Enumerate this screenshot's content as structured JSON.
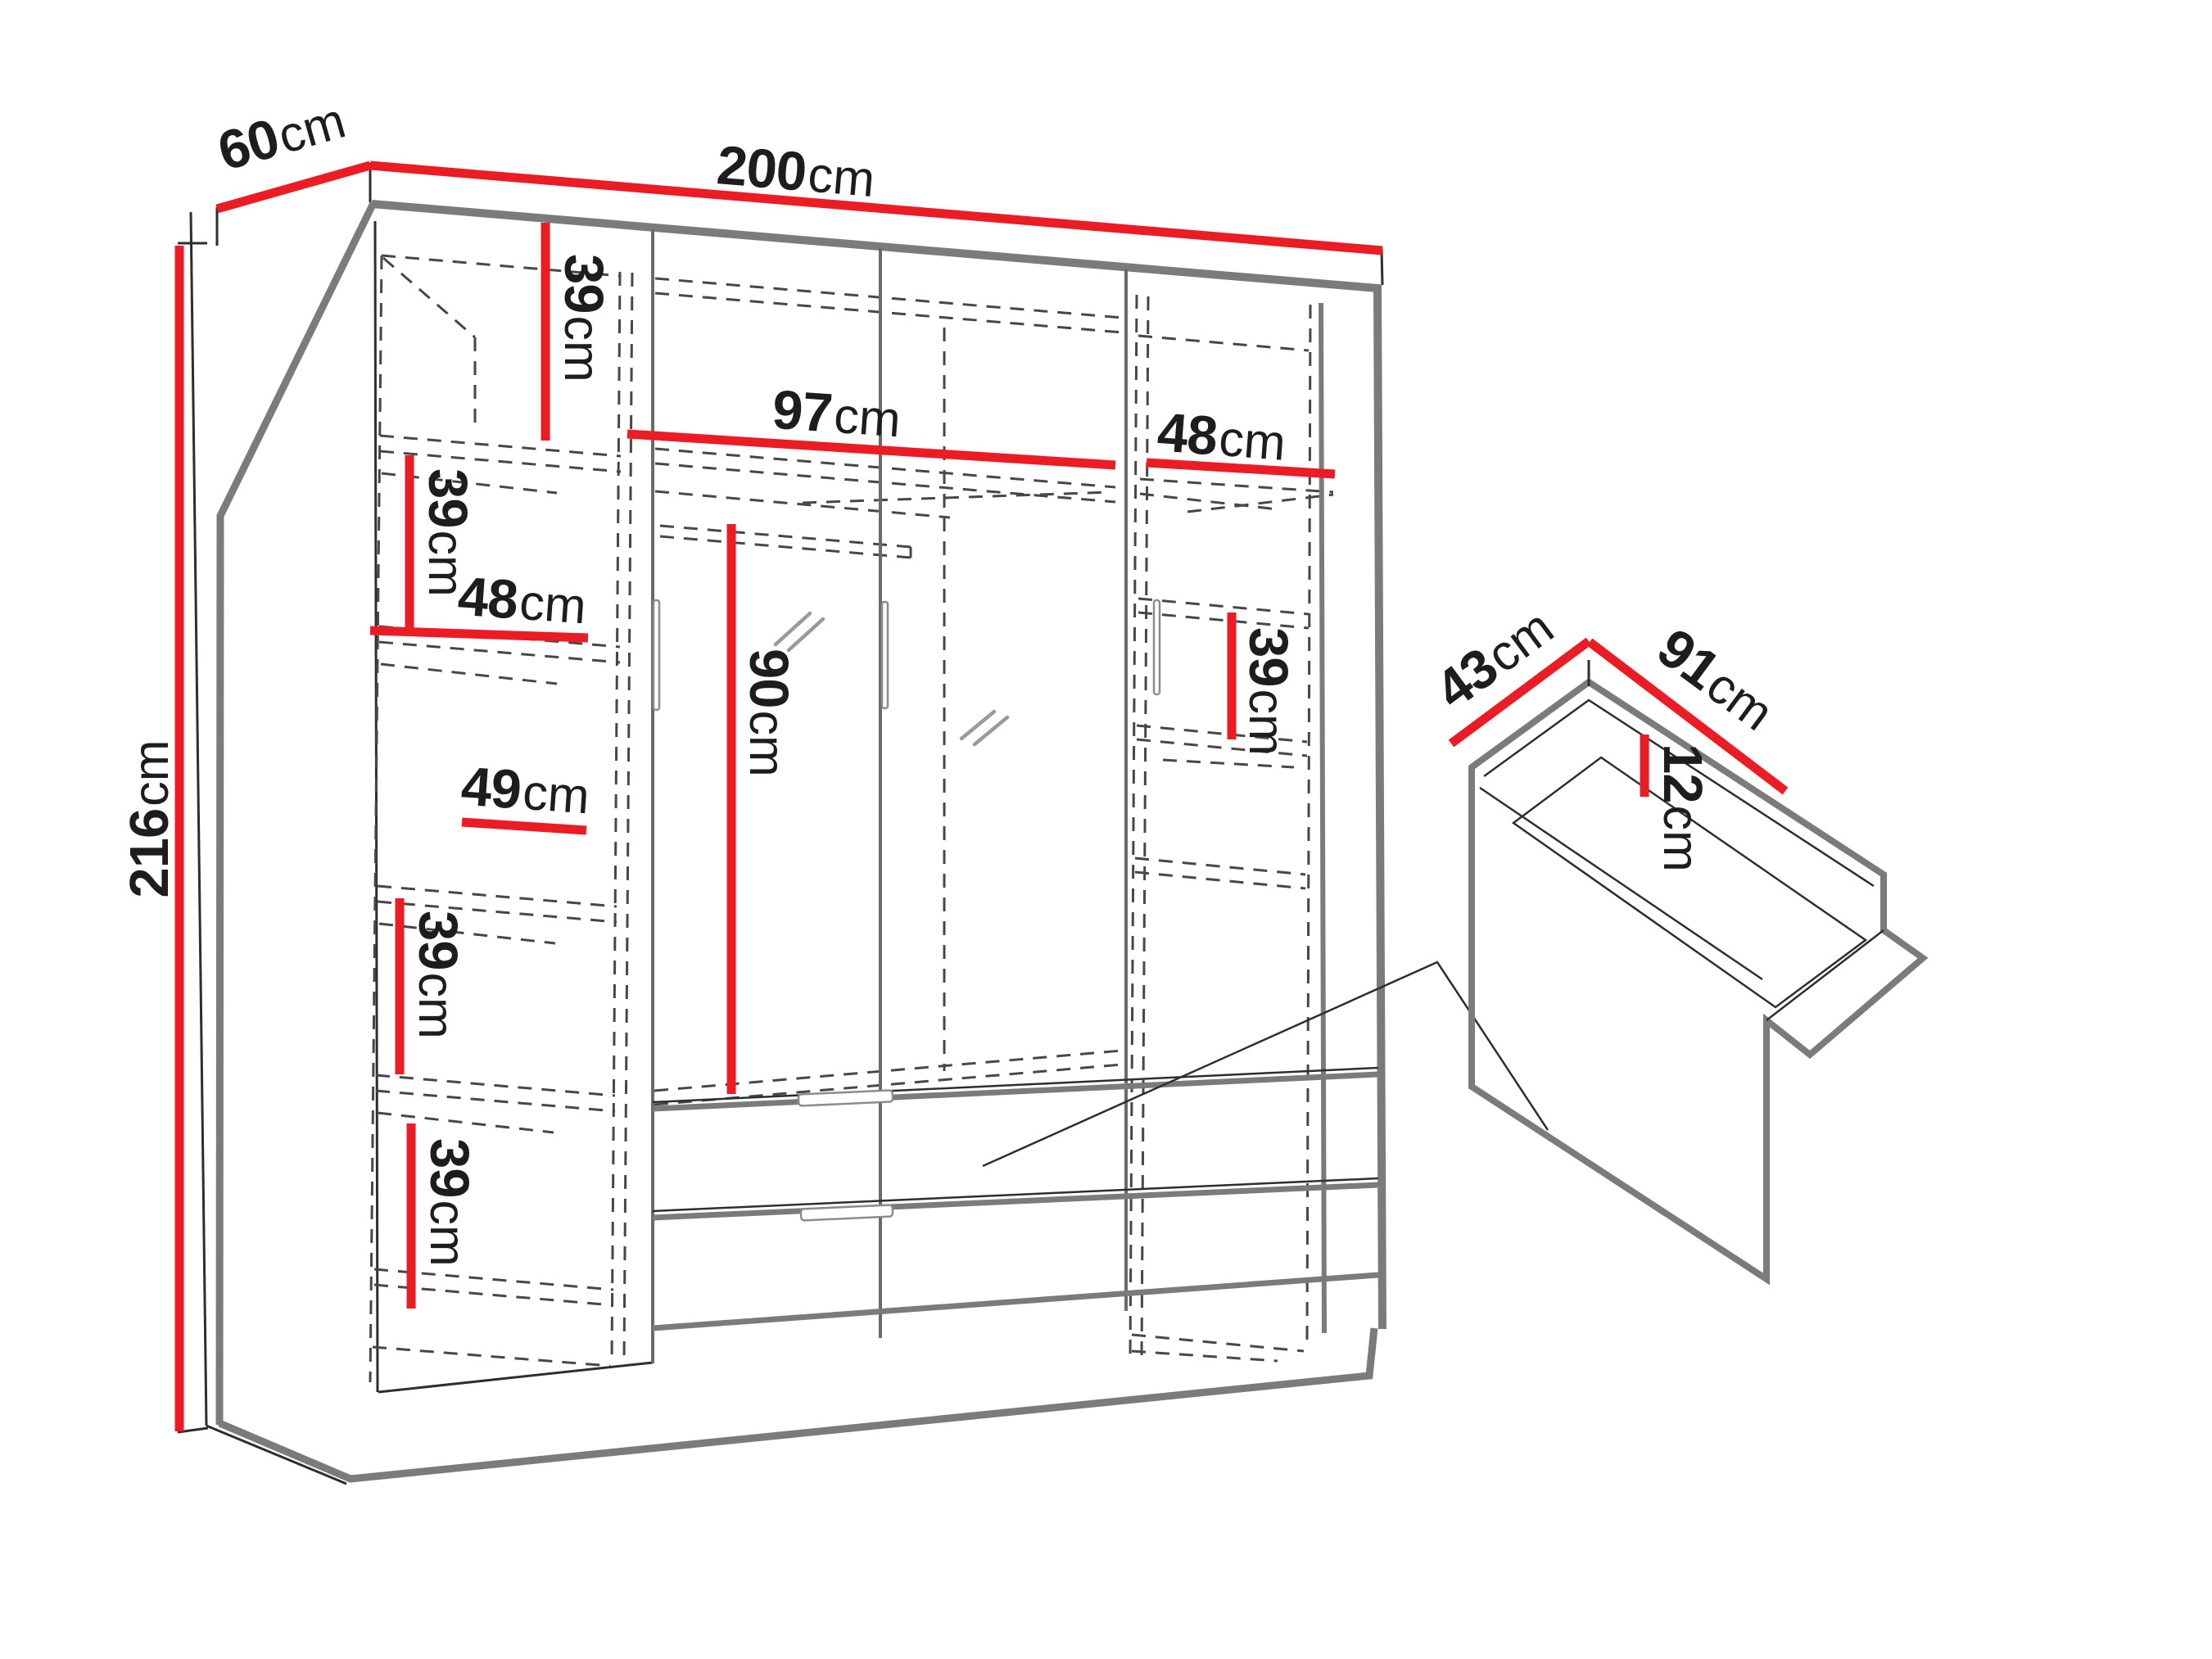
{
  "colors": {
    "dim": "#ec1c24",
    "edge": "#7b7b7b",
    "line": "#2e2e2e",
    "dash": "#474747",
    "text": "#1d1d1f"
  },
  "wardrobe": {
    "width": {
      "num": "200",
      "unit": "cm"
    },
    "depth": {
      "num": "60",
      "unit": "cm"
    },
    "height": {
      "num": "216",
      "unit": "cm"
    },
    "left_column": {
      "shelf_top": {
        "num": "39",
        "unit": "cm"
      },
      "shelf_second": {
        "num": "39",
        "unit": "cm"
      },
      "width_upper": {
        "num": "48",
        "unit": "cm"
      },
      "width_lower": {
        "num": "49",
        "unit": "cm"
      },
      "shelf_third": {
        "num": "39",
        "unit": "cm"
      },
      "shelf_bottom": {
        "num": "39",
        "unit": "cm"
      }
    },
    "middle": {
      "shelf_width": {
        "num": "97",
        "unit": "cm"
      },
      "hanging_height": {
        "num": "90",
        "unit": "cm"
      }
    },
    "right_column": {
      "shelf_width": {
        "num": "48",
        "unit": "cm"
      },
      "shelf_height": {
        "num": "39",
        "unit": "cm"
      }
    }
  },
  "drawer_detail": {
    "depth": {
      "num": "43",
      "unit": "cm"
    },
    "width": {
      "num": "91",
      "unit": "cm"
    },
    "inner_height": {
      "num": "12",
      "unit": "cm"
    }
  }
}
